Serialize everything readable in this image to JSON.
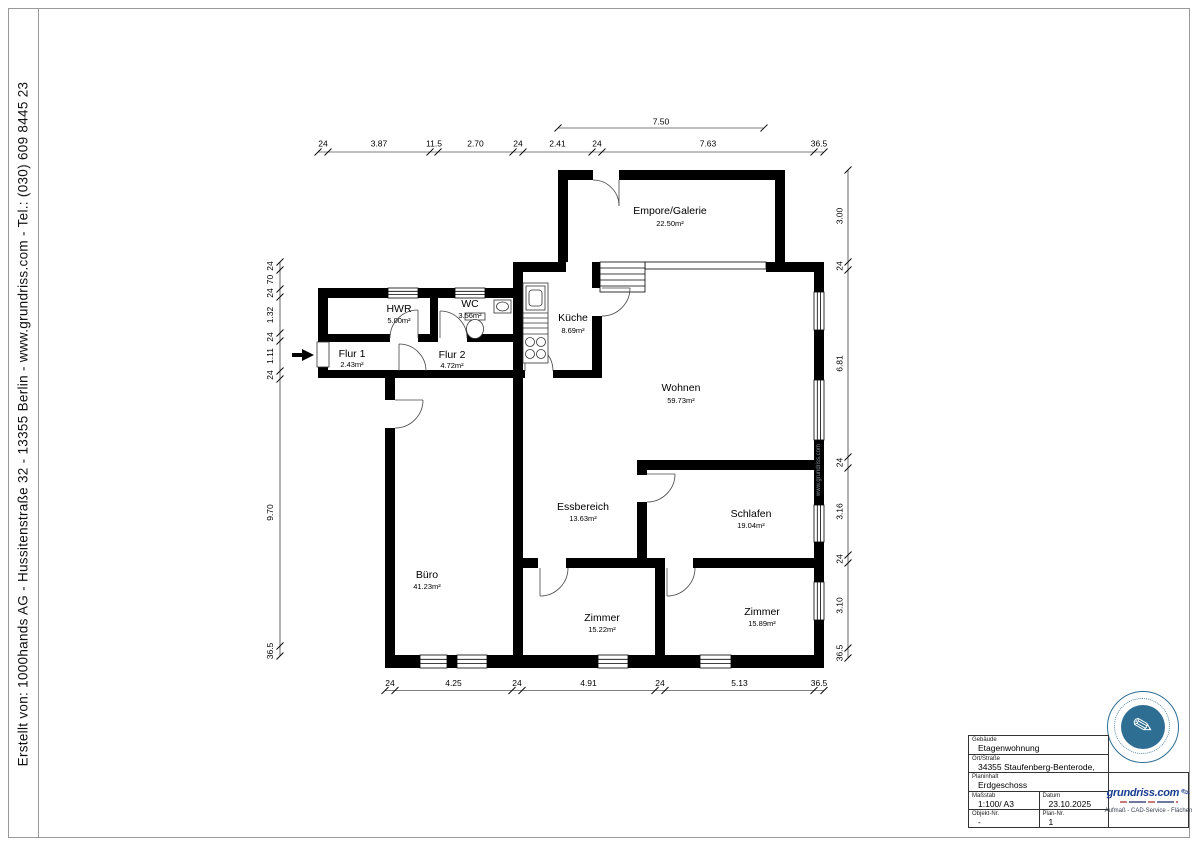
{
  "page": {
    "creator_line": "Erstellt von:  1000hands AG - Hussitenstraße 32 - 13355 Berlin   -   www.grundriss.com   -   Tel.: (030) 609 8445 23"
  },
  "watermark": "www.grundriss.com",
  "rooms": {
    "empore": {
      "name": "Empore/Galerie",
      "area": "22.50m²"
    },
    "hwr": {
      "name": "HWR",
      "area": "5.00m²"
    },
    "wc": {
      "name": "WC",
      "area": "3.56m²"
    },
    "kueche": {
      "name": "Küche",
      "area": "8.69m²"
    },
    "flur1": {
      "name": "Flur 1",
      "area": "2.43m²"
    },
    "flur2": {
      "name": "Flur 2",
      "area": "4.72m²"
    },
    "wohnen": {
      "name": "Wohnen",
      "area": "59.73m²"
    },
    "essbereich": {
      "name": "Essbereich",
      "area": "13.63m²"
    },
    "schlafen": {
      "name": "Schlafen",
      "area": "19.04m²"
    },
    "buero": {
      "name": "Büro",
      "area": "41.23m²"
    },
    "zimmer1": {
      "name": "Zimmer",
      "area": "15.22m²"
    },
    "zimmer2": {
      "name": "Zimmer",
      "area": "15.89m²"
    }
  },
  "dims": {
    "top_span": "7.50",
    "top": [
      "24",
      "3.87",
      "11.5",
      "2.70",
      "24",
      "2.41",
      "24",
      "7.63",
      "36.5"
    ],
    "bottom": [
      "24",
      "4.25",
      "24",
      "4.91",
      "24",
      "5.13",
      "36.5"
    ],
    "left": [
      "24",
      "70",
      "24",
      "1.32",
      "24",
      "1.11",
      "24",
      "9.70",
      "36.5"
    ],
    "right": [
      "3.00",
      "24",
      "6.81",
      "24",
      "3.16",
      "24",
      "3.10",
      "36.5"
    ]
  },
  "titleblock": {
    "gebaeude_label": "Gebäude",
    "gebaeude_value": "Etagenwohnung",
    "ort_label": "Ort/Straße",
    "ort_value": "34355 Staufenberg-Benterode,",
    "planinhalt_label": "Planinhalt",
    "planinhalt_value": "Erdgeschoss",
    "massstab_label": "Maßstab",
    "massstab_value": "1:100/ A3",
    "datum_label": "Datum",
    "datum_value": "23.10.2025",
    "objekt_label": "Objekt-Nr.",
    "objekt_value": "-",
    "plannr_label": "Plan-Nr.",
    "plannr_value": "1",
    "logo_text": "grundriss.com",
    "logo_tagline": "Aufmaß - CAD-Service - Flächen"
  },
  "colors": {
    "wall": "#000000",
    "stamp_blue": "#2e6e93",
    "logo_blue": "#1a3e8f"
  }
}
